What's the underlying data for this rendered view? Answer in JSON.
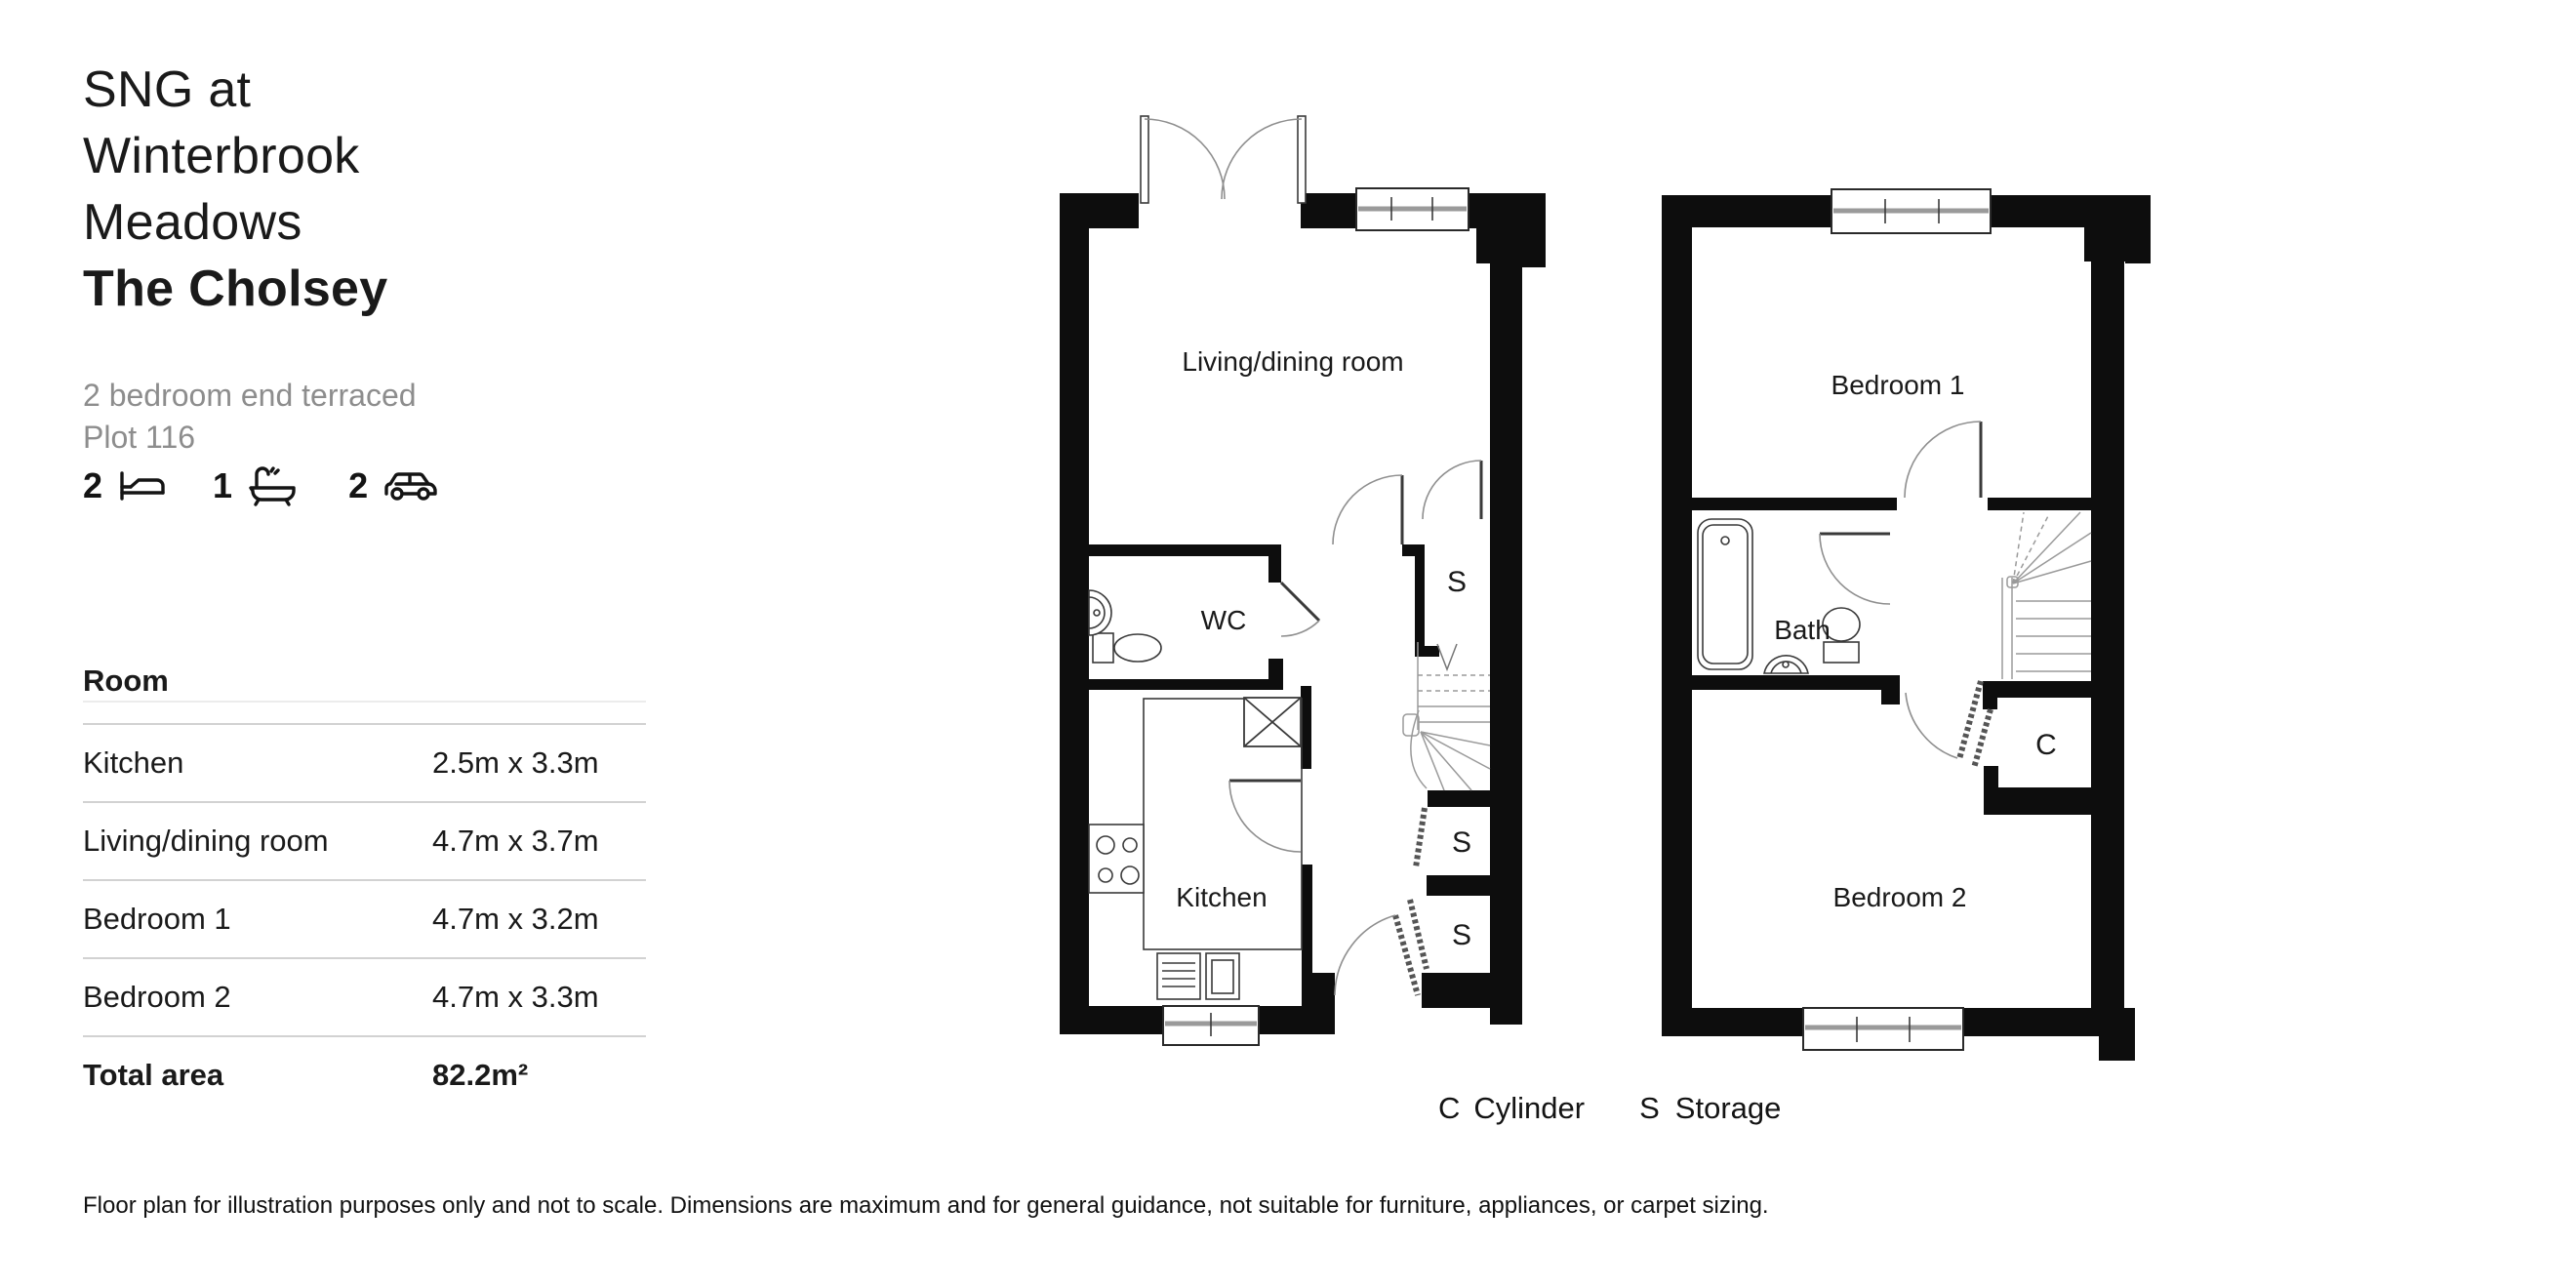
{
  "header": {
    "title_line1": "SNG at",
    "title_line2": "Winterbrook",
    "title_line3": "Meadows",
    "title_bold": "The Cholsey",
    "subtitle_line1": "2 bedroom end terraced",
    "subtitle_line2": "Plot 116"
  },
  "features": {
    "beds": "2",
    "baths": "1",
    "parking": "2"
  },
  "table": {
    "header": "Room",
    "rows": [
      {
        "room": "Kitchen",
        "size": "2.5m x 3.3m"
      },
      {
        "room": "Living/dining room",
        "size": "4.7m x 3.7m"
      },
      {
        "room": "Bedroom 1",
        "size": "4.7m x 3.2m"
      },
      {
        "room": "Bedroom 2",
        "size": "4.7m x 3.3m"
      }
    ],
    "total_label": "Total area",
    "total_value": "82.2m²"
  },
  "plans": {
    "ground": {
      "labels": {
        "living": "Living/dining room",
        "wc": "WC",
        "kitchen": "Kitchen",
        "s1": "S",
        "s2": "S",
        "s3": "S"
      }
    },
    "first": {
      "labels": {
        "bed1": "Bedroom 1",
        "bath": "Bath",
        "bed2": "Bedroom 2",
        "c": "C"
      }
    }
  },
  "legend": {
    "c_key": "C",
    "c_label": "Cylinder",
    "s_key": "S",
    "s_label": "Storage"
  },
  "footer": {
    "disclaimer": "Floor plan for illustration purposes only and not to scale. Dimensions are maximum and for general guidance, not suitable for furniture, appliances, or carpet sizing."
  },
  "colors": {
    "wall": "#0d0d0d",
    "fixture_line": "#3a3a3a",
    "arc_line": "#8f8f8f",
    "stair_line": "#9a9a9a",
    "text": "#1a1a1a",
    "muted_text": "#8d8d8d",
    "divider": "#d2d2d2"
  }
}
